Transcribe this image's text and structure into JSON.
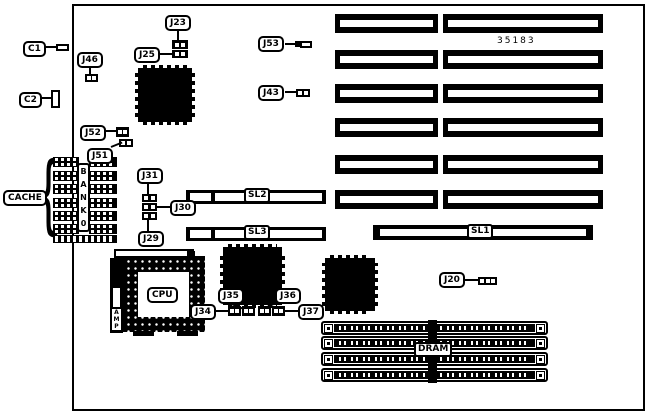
{
  "diagram": {
    "part_number": "35183",
    "background": "#ffffff",
    "line_color": "#000000"
  },
  "callouts": {
    "c1": "C1",
    "c2": "C2",
    "j20": "J20",
    "j23": "J23",
    "j25": "J25",
    "j29": "J29",
    "j30": "J30",
    "j31": "J31",
    "j34": "J34",
    "j35": "J35",
    "j36": "J36",
    "j37": "J37",
    "j43": "J43",
    "j46": "J46",
    "j51": "J51",
    "j52": "J52",
    "j53": "J53",
    "cache": "CACHE"
  },
  "slots": {
    "sl1": "SL1",
    "sl2": "SL2",
    "sl3": "SL3",
    "expansion_slot_count": 6
  },
  "memory": {
    "dram": "DRAM",
    "simm_count": 4
  },
  "cache_bank": {
    "brace": "{",
    "letters": [
      "B",
      "A",
      "N",
      "K",
      "0"
    ],
    "chip_rows": 6,
    "chip_columns": 2
  },
  "cpu": {
    "label": "CPU",
    "amp_letters": [
      "A",
      "M",
      "P"
    ]
  }
}
